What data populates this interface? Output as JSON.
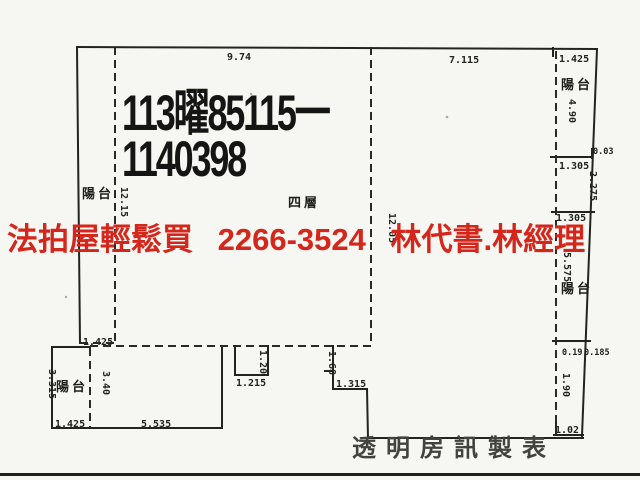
{
  "stamp": {
    "line1": "113曜85115一",
    "line2": "1140398"
  },
  "ad_overlay": {
    "slogan": "法拍屋輕鬆買",
    "phone": "2266-3524",
    "agents": "林代書.林經理",
    "color": "#d5261b"
  },
  "footer": {
    "credit": "透明房訊製表"
  },
  "labels": {
    "balcony": "陽台",
    "floor": "四層"
  },
  "dims": {
    "top_width_left": "9.74",
    "top_width_right": "7.115",
    "tr_balcony_width": "1.425",
    "tr_balcony_height": "4.90",
    "tr_offset": "0.03",
    "right_width_upper": "1.305",
    "right_height_upper": "2.275",
    "right_width_mid": "1.305",
    "right_balcony_height": "5.575",
    "right_step_a": "0.19",
    "right_step_b": "0.185",
    "right_height_lower": "1.90",
    "right_width_bottom": "1.02",
    "left_balcony_height": "12.15",
    "center_height": "12.05",
    "left_balcony_width": "1.425",
    "bl_height_outer": "3.315",
    "bl_height_inner": "3.40",
    "bl_width_balcony": "1.425",
    "bl_width_main": "5.535",
    "tab_height": "1.20",
    "tab_width": "1.215",
    "notch_height": "1.68",
    "notch_width": "1.315"
  }
}
